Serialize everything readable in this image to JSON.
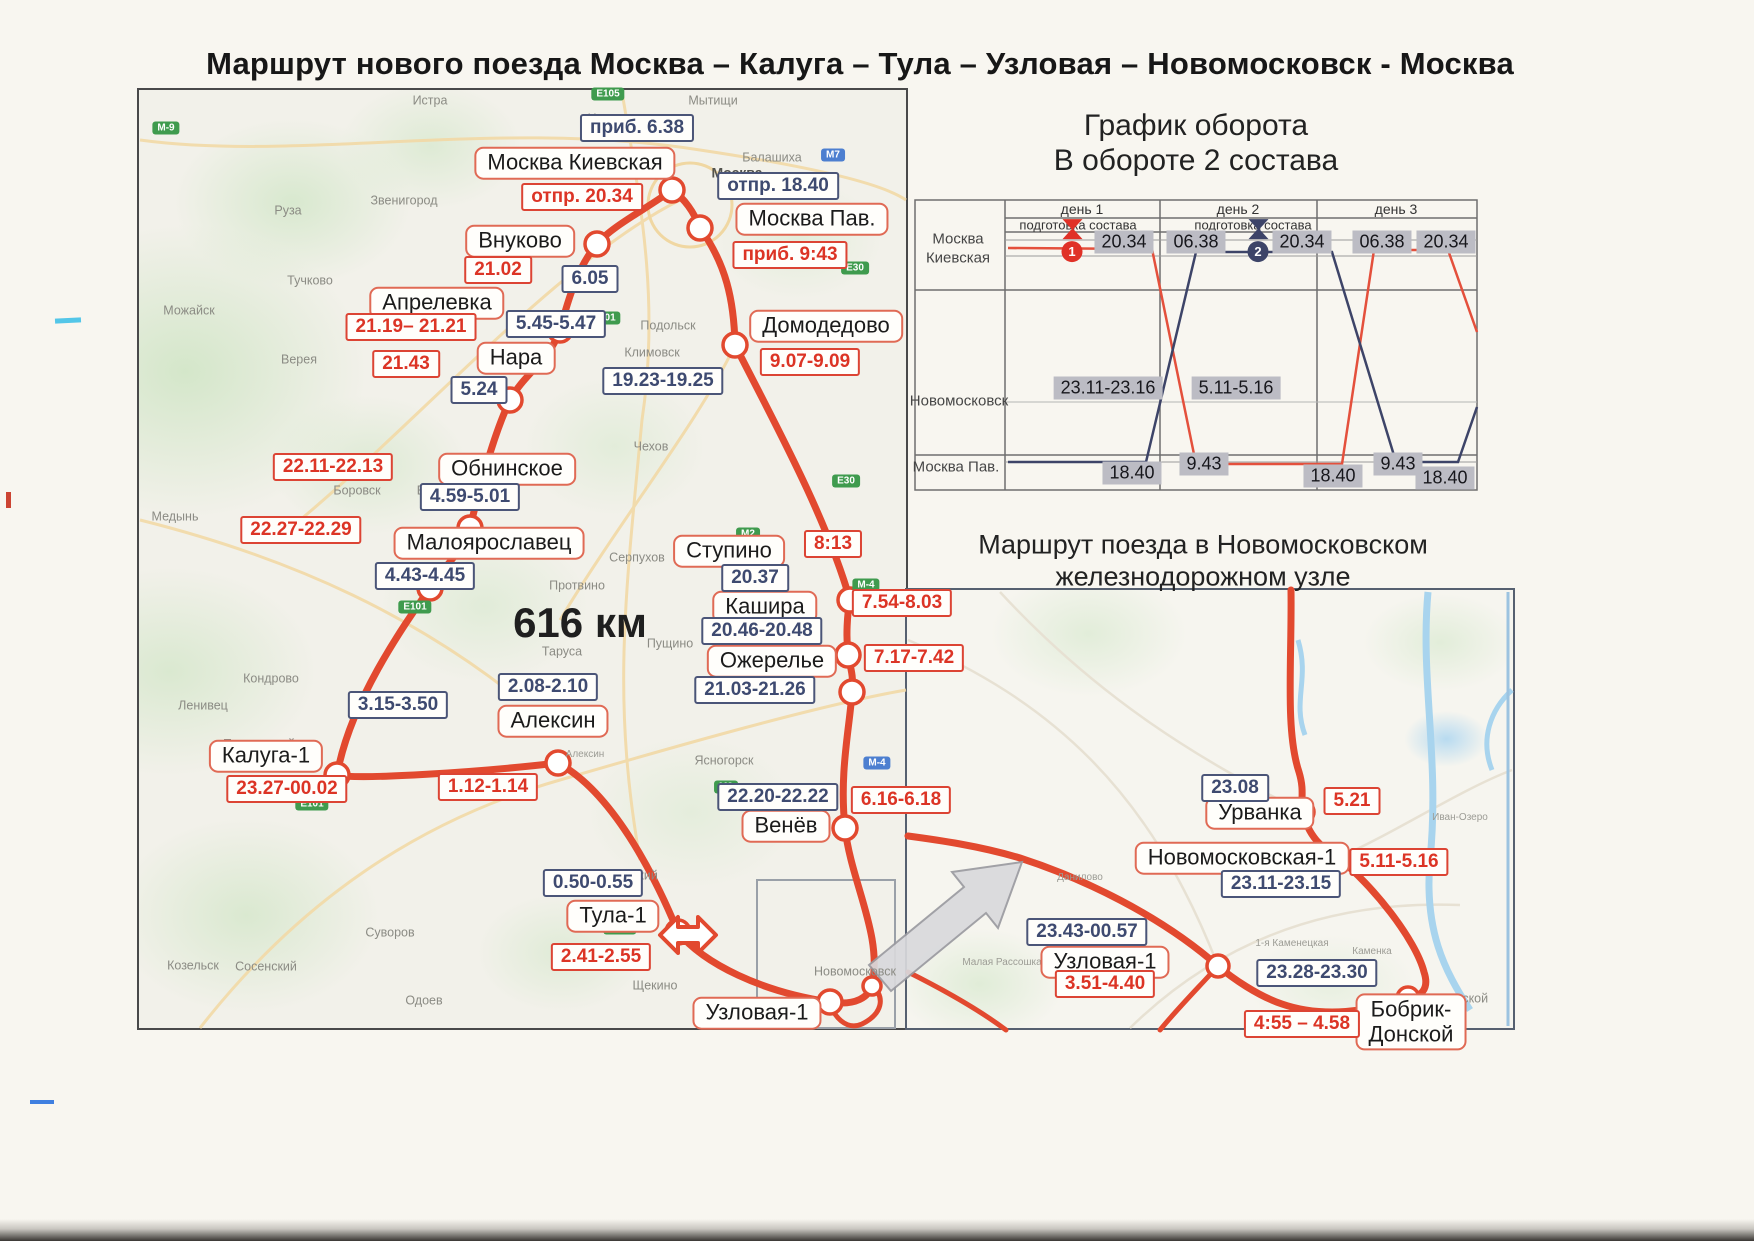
{
  "page_title": "Маршрут нового поезда Москва – Калуга – Тула – Узловая – Новомосковск - Москва",
  "colors": {
    "route_red": "#e2492f",
    "label_border_red": "#e06a55",
    "time_red": "#dc3425",
    "time_dark_blue": "#3e4a70",
    "turnover_gray": "#bcbcc4",
    "turnover_navy": "#3d4468",
    "badge_green": "#3f9b4e",
    "badge_blue": "#4d7fd0"
  },
  "main_map": {
    "distance": "616 км",
    "distance_pos": {
      "x": 580,
      "y": 623
    },
    "stations": [
      {
        "t": "Москва Киевская",
        "x": 575,
        "y": 163
      },
      {
        "t": "Москва Пав.",
        "x": 812,
        "y": 219
      },
      {
        "t": "Внуково",
        "x": 520,
        "y": 241
      },
      {
        "t": "Апрелевка",
        "x": 437,
        "y": 303
      },
      {
        "t": "Нара",
        "x": 516,
        "y": 358
      },
      {
        "t": "Домодедово",
        "x": 826,
        "y": 326
      },
      {
        "t": "Обнинское",
        "x": 507,
        "y": 469
      },
      {
        "t": "Малоярославец",
        "x": 489,
        "y": 543
      },
      {
        "t": "Ступино",
        "x": 729,
        "y": 551
      },
      {
        "t": "Кашира",
        "x": 765,
        "y": 607
      },
      {
        "t": "Ожерелье",
        "x": 772,
        "y": 661
      },
      {
        "t": "Алексин",
        "x": 553,
        "y": 721
      },
      {
        "t": "Калуга-1",
        "x": 266,
        "y": 756
      },
      {
        "t": "Венёв",
        "x": 786,
        "y": 826
      },
      {
        "t": "Тула-1",
        "x": 613,
        "y": 916
      },
      {
        "t": "Узловая-1",
        "x": 757,
        "y": 1013
      },
      {
        "t": "Урванка",
        "x": 1260,
        "y": 813
      },
      {
        "t": "Новомосковская-1",
        "x": 1242,
        "y": 858
      },
      {
        "t": "Узловая-1",
        "x": 1105,
        "y": 962
      },
      {
        "t": "Бобрик-\nДонской",
        "x": 1411,
        "y": 1022
      }
    ],
    "time_labels": [
      {
        "t": "отпр. 20.34",
        "x": 582,
        "y": 197,
        "cls": "red"
      },
      {
        "t": "приб. 9:43",
        "x": 790,
        "y": 255,
        "cls": "red"
      },
      {
        "t": "21.02",
        "x": 498,
        "y": 270,
        "cls": "red"
      },
      {
        "t": "21.19– 21.21",
        "x": 411,
        "y": 327,
        "cls": "red"
      },
      {
        "t": "21.43",
        "x": 406,
        "y": 364,
        "cls": "red"
      },
      {
        "t": "9.07-9.09",
        "x": 810,
        "y": 362,
        "cls": "red"
      },
      {
        "t": "22.11-22.13",
        "x": 333,
        "y": 467,
        "cls": "red"
      },
      {
        "t": "22.27-22.29",
        "x": 301,
        "y": 530,
        "cls": "red"
      },
      {
        "t": "8:13",
        "x": 833,
        "y": 544,
        "cls": "red"
      },
      {
        "t": "7.54-8.03",
        "x": 902,
        "y": 603,
        "cls": "red"
      },
      {
        "t": "7.17-7.42",
        "x": 914,
        "y": 658,
        "cls": "red"
      },
      {
        "t": "23.27-00.02",
        "x": 287,
        "y": 789,
        "cls": "red"
      },
      {
        "t": "1.12-1.14",
        "x": 488,
        "y": 787,
        "cls": "red"
      },
      {
        "t": "6.16-6.18",
        "x": 901,
        "y": 800,
        "cls": "red"
      },
      {
        "t": "2.41-2.55",
        "x": 601,
        "y": 957,
        "cls": "red"
      },
      {
        "t": "5.21",
        "x": 1352,
        "y": 801,
        "cls": "red"
      },
      {
        "t": "5.11-5.16",
        "x": 1399,
        "y": 862,
        "cls": "red"
      },
      {
        "t": "3.51-4.40",
        "x": 1105,
        "y": 984,
        "cls": "red"
      },
      {
        "t": "4:55 – 4.58",
        "x": 1302,
        "y": 1024,
        "cls": "red"
      },
      {
        "t": "приб. 6.38",
        "x": 637,
        "y": 128,
        "cls": "dark"
      },
      {
        "t": "отпр. 18.40",
        "x": 778,
        "y": 186,
        "cls": "dark"
      },
      {
        "t": "6.05",
        "x": 590,
        "y": 279,
        "cls": "dark"
      },
      {
        "t": "5.45-5.47",
        "x": 556,
        "y": 324,
        "cls": "dark"
      },
      {
        "t": "5.24",
        "x": 479,
        "y": 390,
        "cls": "dark"
      },
      {
        "t": "19.23-19.25",
        "x": 663,
        "y": 381,
        "cls": "dark"
      },
      {
        "t": "4.59-5.01",
        "x": 470,
        "y": 497,
        "cls": "dark"
      },
      {
        "t": "4.43-4.45",
        "x": 425,
        "y": 576,
        "cls": "dark"
      },
      {
        "t": "20.37",
        "x": 755,
        "y": 578,
        "cls": "dark"
      },
      {
        "t": "20.46-20.48",
        "x": 762,
        "y": 631,
        "cls": "dark"
      },
      {
        "t": "21.03-21.26",
        "x": 755,
        "y": 690,
        "cls": "dark"
      },
      {
        "t": "2.08-2.10",
        "x": 548,
        "y": 687,
        "cls": "dark"
      },
      {
        "t": "3.15-3.50",
        "x": 398,
        "y": 705,
        "cls": "dark"
      },
      {
        "t": "22.20-22.22",
        "x": 778,
        "y": 797,
        "cls": "dark"
      },
      {
        "t": "0.50-0.55",
        "x": 593,
        "y": 883,
        "cls": "dark"
      },
      {
        "t": "23.08",
        "x": 1235,
        "y": 788,
        "cls": "dark"
      },
      {
        "t": "23.11-23.15",
        "x": 1281,
        "y": 884,
        "cls": "dark"
      },
      {
        "t": "23.43-00.57",
        "x": 1087,
        "y": 932,
        "cls": "dark"
      },
      {
        "t": "23.28-23.30",
        "x": 1317,
        "y": 973,
        "cls": "dark"
      }
    ],
    "places": [
      {
        "t": "Истра",
        "x": 430,
        "y": 101
      },
      {
        "t": "Химки",
        "x": 606,
        "y": 119
      },
      {
        "t": "Мытищи",
        "x": 713,
        "y": 101
      },
      {
        "t": "Балашиха",
        "x": 772,
        "y": 158
      },
      {
        "t": "Москва",
        "x": 737,
        "y": 173,
        "cls": "city"
      },
      {
        "t": "Звенигород",
        "x": 404,
        "y": 201
      },
      {
        "t": "Руза",
        "x": 288,
        "y": 211
      },
      {
        "t": "Тучково",
        "x": 310,
        "y": 281
      },
      {
        "t": "Можайск",
        "x": 189,
        "y": 311
      },
      {
        "t": "Верея",
        "x": 299,
        "y": 360
      },
      {
        "t": "Подольск",
        "x": 668,
        "y": 326
      },
      {
        "t": "Климовск",
        "x": 652,
        "y": 353
      },
      {
        "t": "Чехов",
        "x": 651,
        "y": 447
      },
      {
        "t": "Боровск",
        "x": 357,
        "y": 491
      },
      {
        "t": "Балабаново",
        "x": 452,
        "y": 491
      },
      {
        "t": "Медынь",
        "x": 175,
        "y": 517
      },
      {
        "t": "Серпухов",
        "x": 637,
        "y": 558
      },
      {
        "t": "Протвино",
        "x": 577,
        "y": 586
      },
      {
        "t": "Пущино",
        "x": 670,
        "y": 644
      },
      {
        "t": "Таруса",
        "x": 562,
        "y": 652
      },
      {
        "t": "Кондрово",
        "x": 271,
        "y": 679
      },
      {
        "t": "Ленивец",
        "x": 203,
        "y": 706
      },
      {
        "t": "Полотняный\nЗавод",
        "x": 259,
        "y": 752
      },
      {
        "t": "Алексин",
        "x": 585,
        "y": 755,
        "cls": "sm"
      },
      {
        "t": "Ясногорск",
        "x": 724,
        "y": 761
      },
      {
        "t": "Ленинский",
        "x": 627,
        "y": 876
      },
      {
        "t": "Суворов",
        "x": 390,
        "y": 933
      },
      {
        "t": "Щекино",
        "x": 655,
        "y": 986
      },
      {
        "t": "Козельск",
        "x": 193,
        "y": 966
      },
      {
        "t": "Сосенский",
        "x": 266,
        "y": 967
      },
      {
        "t": "Одоев",
        "x": 424,
        "y": 1001
      },
      {
        "t": "Новомосковск",
        "x": 855,
        "y": 972
      },
      {
        "t": "Донской",
        "x": 1464,
        "y": 999
      },
      {
        "t": "Каменка",
        "x": 1372,
        "y": 952,
        "cls": "sm"
      },
      {
        "t": "Данилово",
        "x": 1080,
        "y": 878,
        "cls": "sm"
      },
      {
        "t": "Малая Рассошка",
        "x": 1002,
        "y": 963,
        "cls": "sm"
      },
      {
        "t": "1-я Каменецкая",
        "x": 1292,
        "y": 944,
        "cls": "sm"
      },
      {
        "t": "Иван-Озеро",
        "x": 1460,
        "y": 818,
        "cls": "sm"
      }
    ],
    "road_badges": [
      {
        "t": "М-9",
        "x": 166,
        "y": 128,
        "cls": "g"
      },
      {
        "t": "Е105",
        "x": 608,
        "y": 94,
        "cls": "g"
      },
      {
        "t": "М7",
        "x": 833,
        "y": 155,
        "cls": "b"
      },
      {
        "t": "Е101",
        "x": 604,
        "y": 318,
        "cls": "g"
      },
      {
        "t": "Е30",
        "x": 855,
        "y": 268,
        "cls": "g"
      },
      {
        "t": "Е30",
        "x": 846,
        "y": 481,
        "cls": "g"
      },
      {
        "t": "М2",
        "x": 748,
        "y": 534,
        "cls": "g"
      },
      {
        "t": "М-4",
        "x": 866,
        "y": 585,
        "cls": "g"
      },
      {
        "t": "Е101",
        "x": 415,
        "y": 607,
        "cls": "g"
      },
      {
        "t": "М2",
        "x": 726,
        "y": 787,
        "cls": "g"
      },
      {
        "t": "М-4",
        "x": 877,
        "y": 763,
        "cls": "b"
      },
      {
        "t": "Е101",
        "x": 312,
        "y": 804,
        "cls": "g"
      },
      {
        "t": "Е105",
        "x": 620,
        "y": 928,
        "cls": "g"
      }
    ]
  },
  "turnover": {
    "title_line1": "График оборота",
    "title_line2": "В обороте 2 состава",
    "day_headers": [
      {
        "t": "день 1",
        "x": 1082,
        "y": 209
      },
      {
        "t": "день 2",
        "x": 1238,
        "y": 209
      },
      {
        "t": "день 3",
        "x": 1396,
        "y": 209
      }
    ],
    "prep_labels": [
      {
        "t": "подготовка состава",
        "x": 1078,
        "y": 225
      },
      {
        "t": "подготовка состава",
        "x": 1253,
        "y": 225
      }
    ],
    "row_labels": [
      {
        "t": "Москва\nКиевская",
        "x": 958,
        "y": 249
      },
      {
        "t": "Новомосковск",
        "x": 959,
        "y": 402
      },
      {
        "t": "Москва Пав.",
        "x": 956,
        "y": 468
      }
    ],
    "time_cells": [
      {
        "t": "20.34",
        "x": 1124,
        "y": 242
      },
      {
        "t": "06.38",
        "x": 1196,
        "y": 242
      },
      {
        "t": "20.34",
        "x": 1302,
        "y": 242
      },
      {
        "t": "06.38",
        "x": 1382,
        "y": 242
      },
      {
        "t": "20.34",
        "x": 1446,
        "y": 242
      },
      {
        "t": "23.11-23.16",
        "x": 1108,
        "y": 388
      },
      {
        "t": "5.11-5.16",
        "x": 1236,
        "y": 388
      },
      {
        "t": "18.40",
        "x": 1132,
        "y": 473
      },
      {
        "t": "9.43",
        "x": 1204,
        "y": 464
      },
      {
        "t": "18.40",
        "x": 1333,
        "y": 476
      },
      {
        "t": "9.43",
        "x": 1398,
        "y": 464
      },
      {
        "t": "18.40",
        "x": 1445,
        "y": 478
      }
    ],
    "markers": [
      {
        "n": "1",
        "x": 1072,
        "y": 232,
        "cls": "red"
      },
      {
        "n": "2",
        "x": 1258,
        "y": 232,
        "cls": "navy"
      }
    ]
  },
  "junction": {
    "title_line1": "Маршрут поезда в Новомосковском",
    "title_line2": "железнодорожном узле"
  }
}
